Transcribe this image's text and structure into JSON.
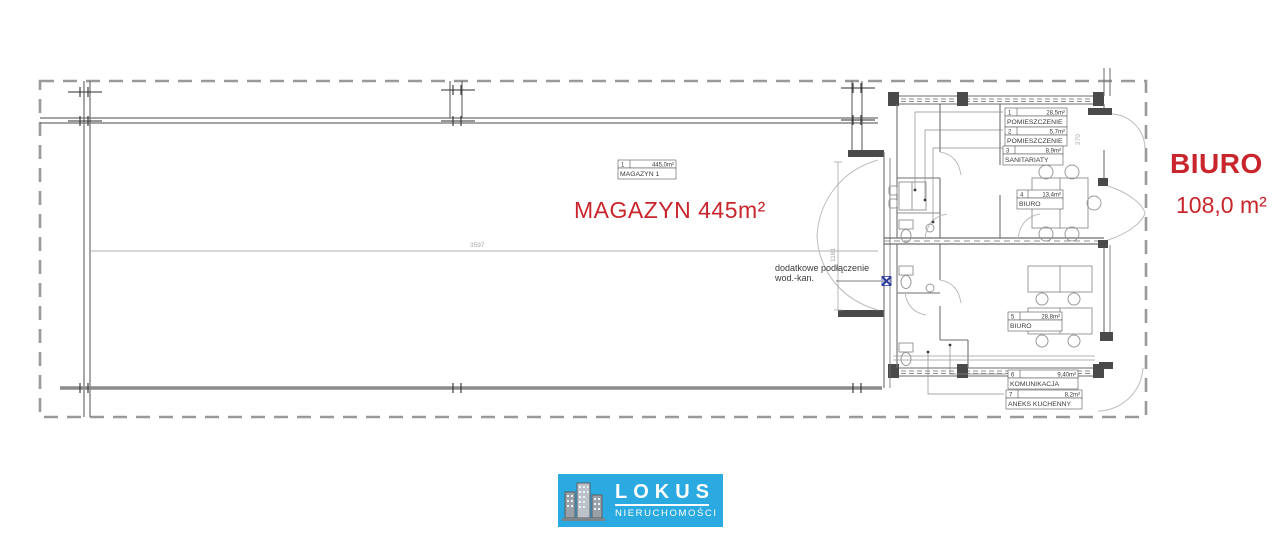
{
  "plan": {
    "magazyn": {
      "table": {
        "num": "1",
        "area": "445,0m²",
        "name": "MAGAZYN 1"
      },
      "label": "MAGAZYN 445m²"
    },
    "annotation": {
      "line1": "dodatkowe podłączenie",
      "line2": "wod.-kan."
    },
    "rooms": [
      {
        "num": "1",
        "area": "28,5m²",
        "name": "POMIESZCZENIE"
      },
      {
        "num": "2",
        "area": "5,7m²",
        "name": "POMIESZCZENIE"
      },
      {
        "num": "3",
        "area": "8,9m²",
        "name": "SANITARIATY"
      },
      {
        "num": "4",
        "area": "13,4m²",
        "name": "BIURO"
      },
      {
        "num": "5",
        "area": "28,8m²",
        "name": "BIURO"
      },
      {
        "num": "6",
        "area": "9,40m²",
        "name": "KOMUNIKACJA"
      },
      {
        "num": "7",
        "area": "8,2m²",
        "name": "ANEKS KUCHENNY"
      }
    ],
    "dimensions": {
      "d1": "3597",
      "d2": "1181",
      "d3": "270"
    },
    "side_label": {
      "title": "BIURO",
      "area": "108,0 m²"
    }
  },
  "logo": {
    "title": "LOKUS",
    "subtitle": "NIERUCHOMOŚCI"
  },
  "colors": {
    "red": "#c9252c",
    "logo_blue": "#2ba9e1",
    "marker_blue": "#2b3a9e"
  }
}
